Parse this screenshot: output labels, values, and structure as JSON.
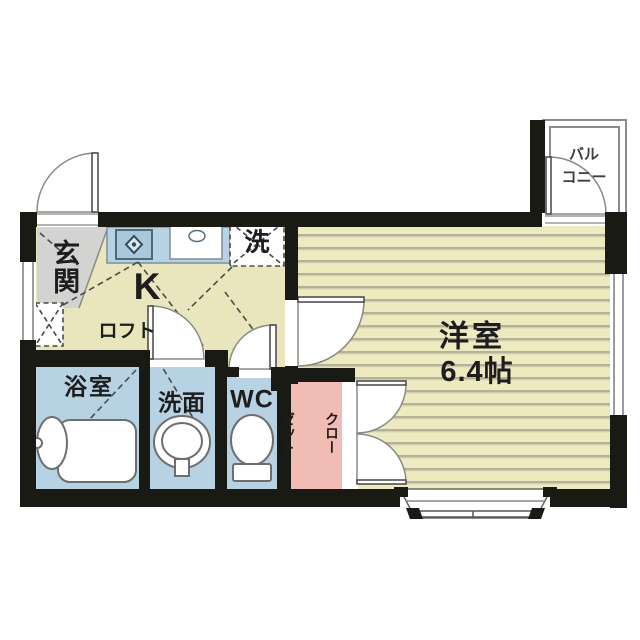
{
  "floorplan": {
    "rooms": {
      "genkan": {
        "label": "玄関"
      },
      "kitchen": {
        "label": "K"
      },
      "loft": {
        "label": "ロフト"
      },
      "laundry": {
        "label": "洗"
      },
      "bathroom": {
        "label": "浴室"
      },
      "washroom": {
        "label": "洗面"
      },
      "toilet": {
        "label": "WC"
      },
      "closet": {
        "label": "クローゼット",
        "line1": "クロー",
        "line2": "ゼット"
      },
      "western_room": {
        "label": "洋室",
        "size": "6.4帖"
      },
      "balcony": {
        "label": "バルコニー",
        "line1": "バル",
        "line2": "コニー"
      }
    },
    "colors": {
      "wall": "#1a1a14",
      "floor_hall": "#e9e6bd",
      "floor_room": "#edeac0",
      "floor_stripe": "#b4b19b",
      "wet_area_blue": "#b7d2e2",
      "stove_blue": "#a9c9db",
      "genkan_tile_gray": "#d3d3d1",
      "closet_pink": "#f0bcb4"
    }
  }
}
